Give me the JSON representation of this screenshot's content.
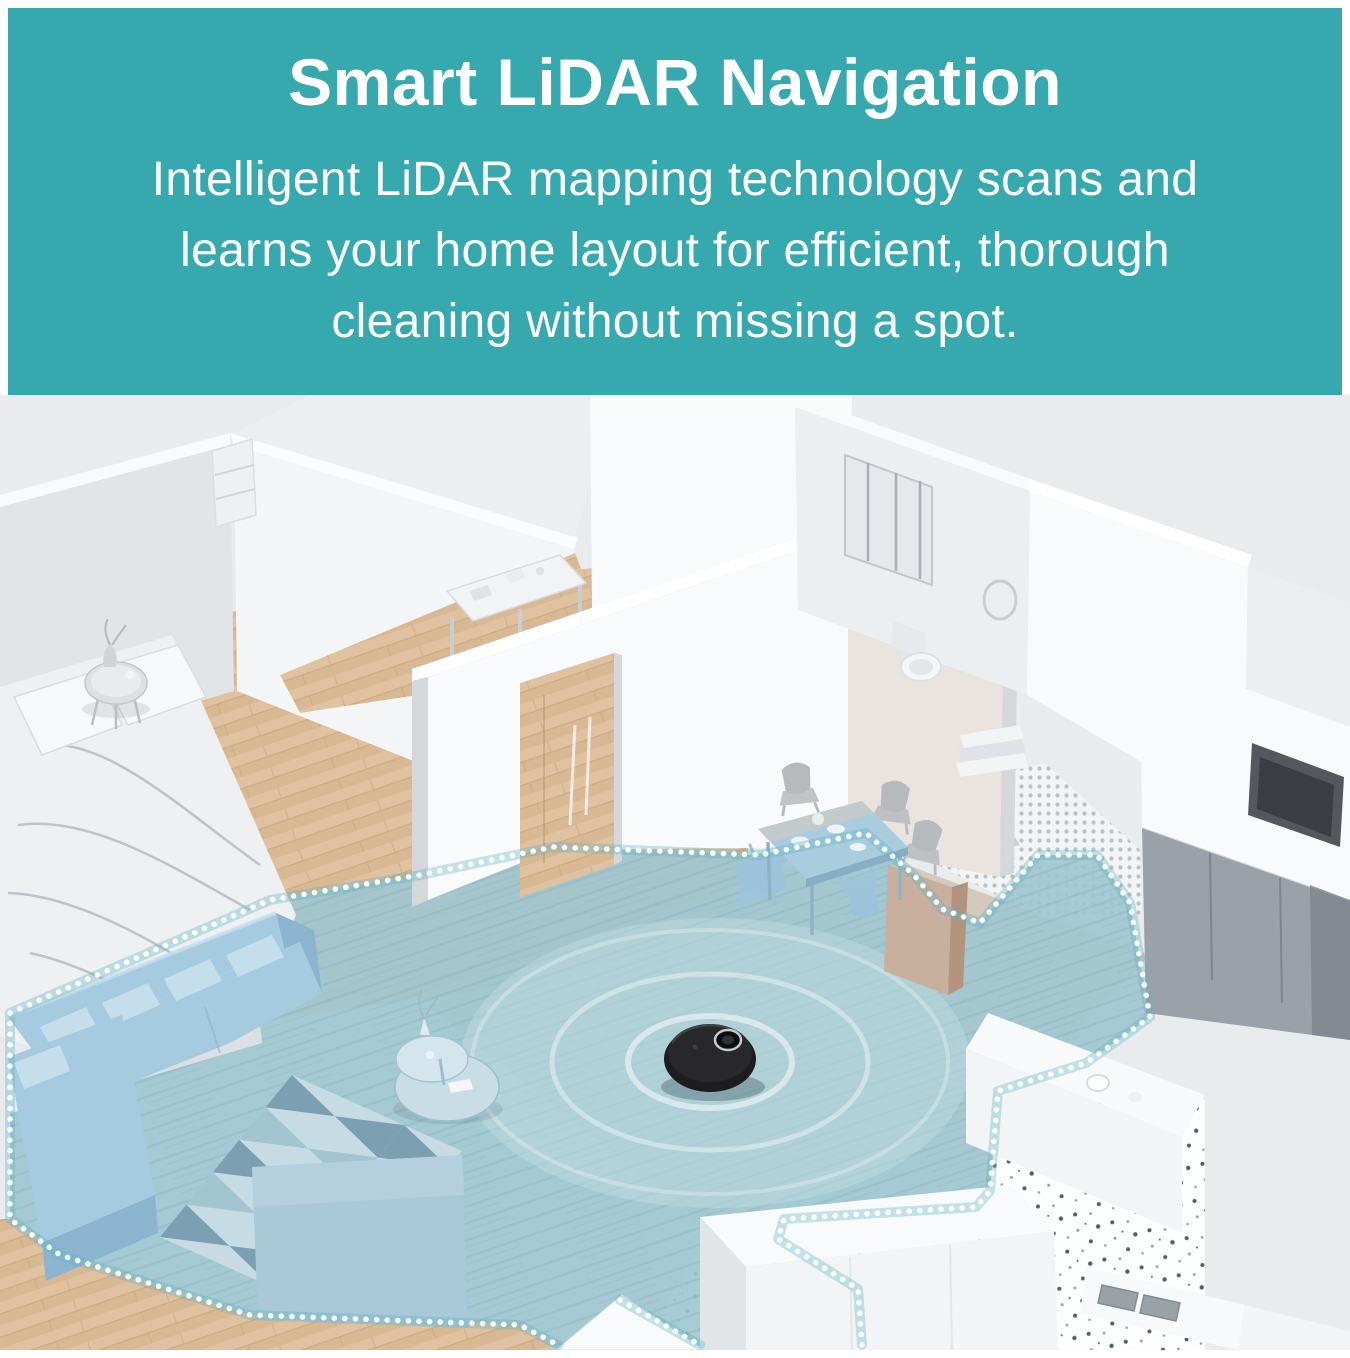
{
  "header": {
    "title": "Smart LiDAR Navigation",
    "subtitle_lines": [
      "Intelligent LiDAR mapping technology scans and",
      "learns your home layout for efficient, thorough",
      "cleaning without missing a spot."
    ]
  },
  "palette": {
    "page_bg": "#ffffff",
    "header_bg": "#35a9ae",
    "header_text": "#ffffff",
    "scene_bg": "#e9ebec",
    "wall_light": "#f8fafb",
    "wall_mid": "#eceff1",
    "wall_shade": "#e1e5e8",
    "wall_dark": "#d4d8db",
    "wall_warm": "#e9e4e0",
    "wood": "#d9b994",
    "wood_light": "#e0c2a0",
    "wood_streak": "#c8a67d",
    "wood_gray": "#cfc4b5",
    "zone_fill": "#9fc7d1",
    "zone_streak": "#7fa9b4",
    "zone_glow": "#c2dde2",
    "zone_dot": "#ffffff",
    "zone_halo": "#5cb4c2",
    "sofa": "#a6cbe0",
    "sofa_dark": "#8bb5cf",
    "sofa_light": "#c5deec",
    "rug_light": "#c6dbe4",
    "rug_mid": "#a3c4d1",
    "rug_dark": "#7d9fb2",
    "slab_blue": "#a9c8d8",
    "robot_body": "#1d1d20",
    "robot_top": "#28282c",
    "robot_dark": "#0d0d0f",
    "metal": "#c6cacf",
    "terrazzo": "#fcfdfd",
    "speckle_dark": "#575d64",
    "speckle_mid": "#9aa1a8",
    "mosaic_bg": "#f2f4f5",
    "mosaic_dot": "#b9c0c6",
    "mosaic_dark": "#97a0a7",
    "cabinet_gray": "#9ba1a8",
    "cabinet_dark": "#7e858c",
    "beige": "#c9b09e",
    "beige_dark": "#b3947f",
    "tv_frame": "#54585d",
    "tv_screen": "#3a3e43",
    "chair_gray": "#b7babd",
    "chair_blue": "#9cc3d9",
    "fixture": "#f2f4f5",
    "fixture_shade": "#dde1e4"
  }
}
